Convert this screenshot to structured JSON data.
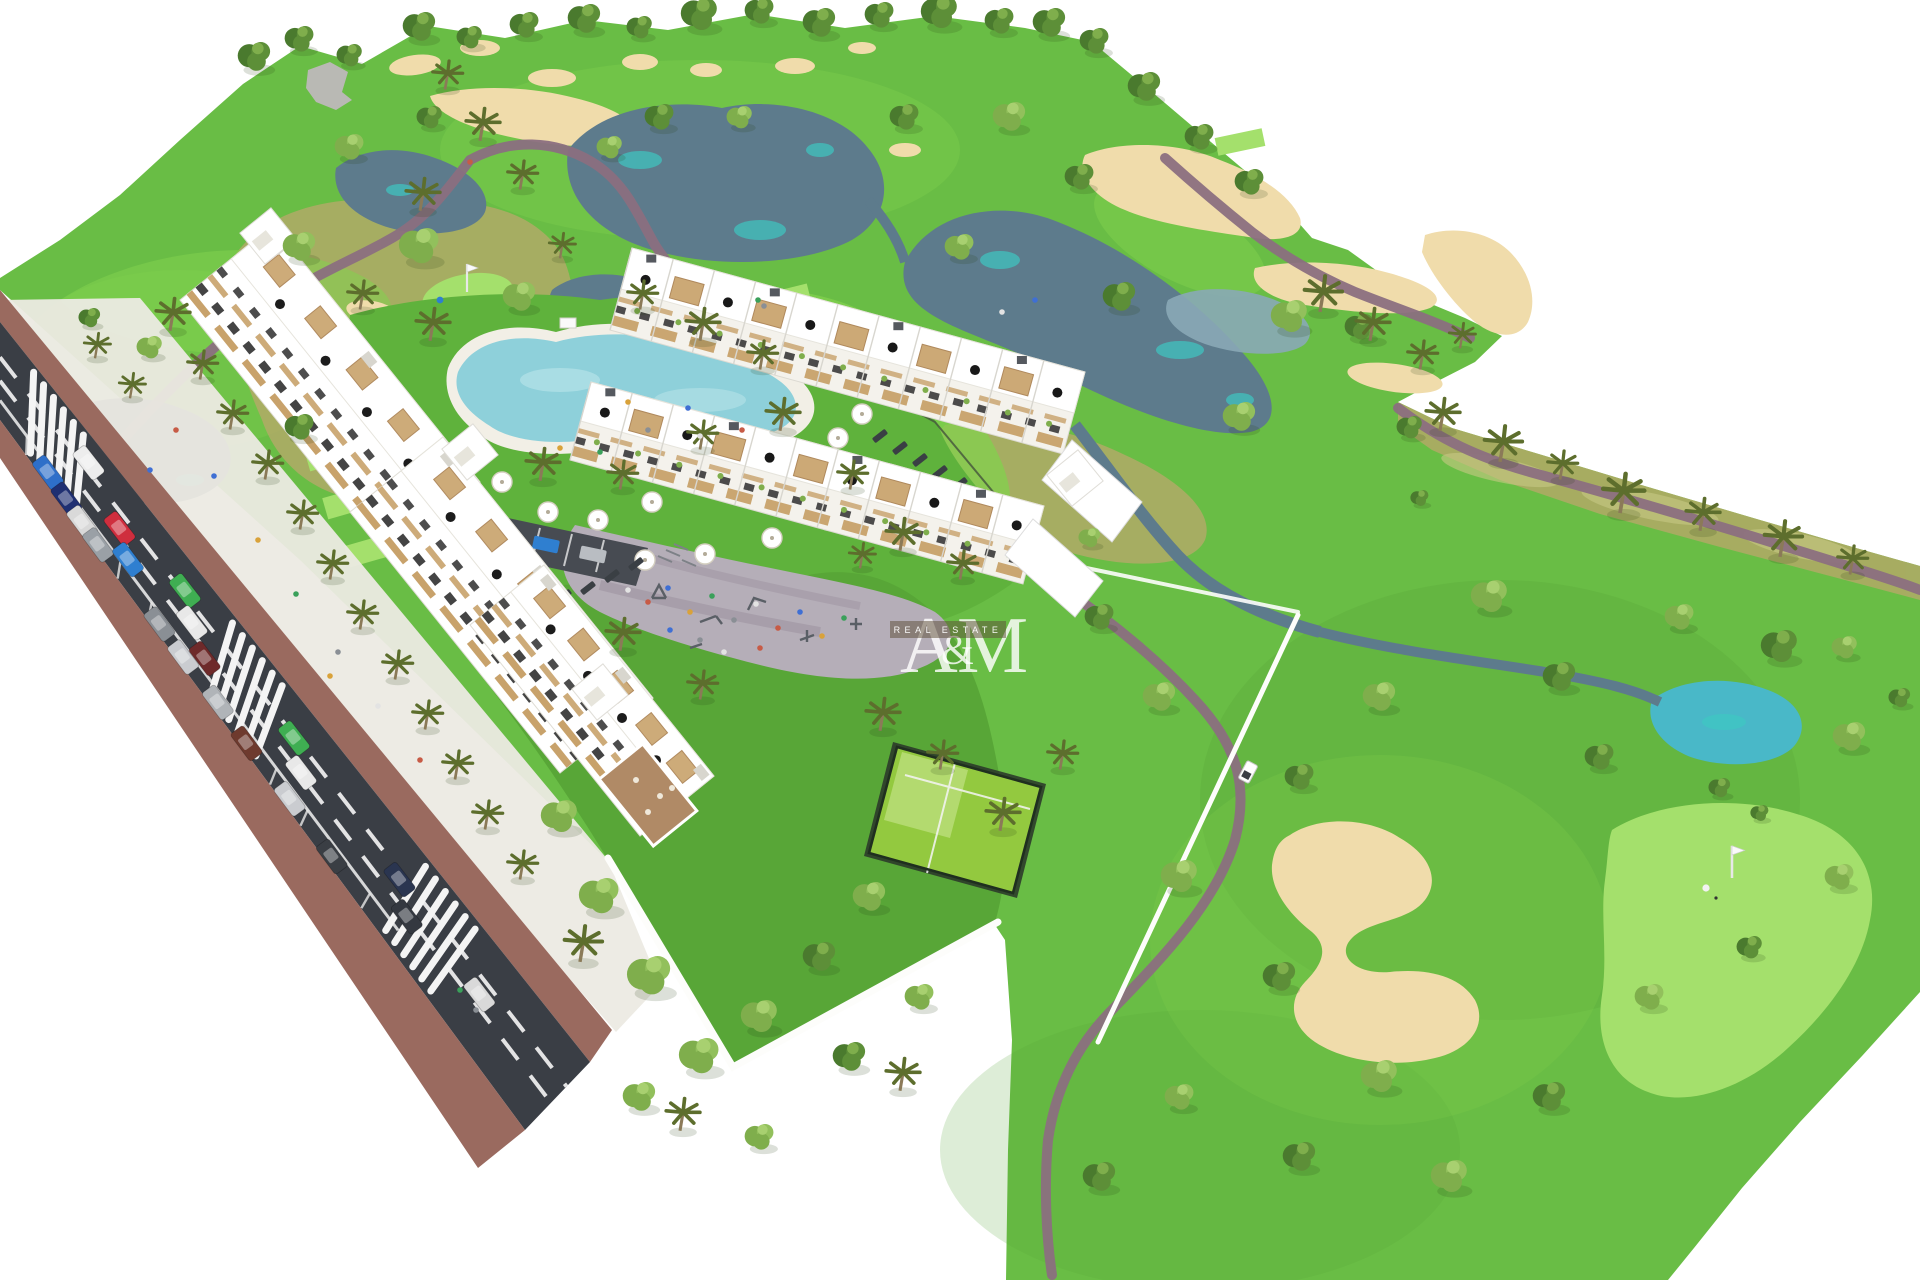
{
  "title": "Aerial 3D architectural rendering of a golf-resort residential development",
  "watermark": {
    "letter_a": "A",
    "ampersand": "&",
    "letter_m": "M",
    "tagline": "REAL ESTATE"
  },
  "palette": {
    "grass": "#69bd45",
    "grassDark": "#56a437",
    "fairway": "#82d14e",
    "greenLight": "#a4e06c",
    "scrub": "#b2aa67",
    "scrubSand": "#d8ca90",
    "sand": "#f0dcab",
    "water": "#5d7b8c",
    "waterLight": "#8aa9b6",
    "waterTeal": "#3ec7c2",
    "pond": "#49b8c8",
    "path": "#8b6f80",
    "road": "#3a3e45",
    "roadLight": "#4a4f57",
    "sidewalk": "#9a6a5f",
    "driveway": "#eceae3",
    "white": "#ffffff",
    "offWhite": "#f4f2ec",
    "facade": "#e7e5dc",
    "wood": "#c8a26b",
    "woodDark": "#a97f4f",
    "windowDark": "#3a3a3a",
    "pool": "#8ed0da",
    "poolLight": "#b5e2e8",
    "court": "#93c93f",
    "courtLight": "#c4e488",
    "wall": "#fdfdfb",
    "plaza": "#b5aeb8",
    "plazaPath": "#a49aa6",
    "parking": "#474b52",
    "fence": "#2c3b2a",
    "treeDark": "#4a7a2e",
    "tree": "#5d8f38",
    "treeLight": "#7fae4c",
    "treeLight2": "#92c05c",
    "palm": "#5d6e2d",
    "trunk": "#8b7a58",
    "rock": "#b9b9b4",
    "shadow": "rgba(40,60,20,0.16)"
  },
  "scene": {
    "setting": "golf course with lakes, sand bunkers, winding cart paths, fairways, tee boxes and palm trees on white background",
    "development": "white modern apartment block with stepped terraces and two long rows of townhouses with roof terraces, pergolas and parasols",
    "amenities": [
      "lagoon swimming pool with sun umbrellas and loungers",
      "children's playground and outdoor gym plaza",
      "padel court with dark fence",
      "private walled gardens",
      "small parking court with bike racks"
    ],
    "surroundings": [
      "diagonal two-lane access road with dashed markings",
      "brick sidewalks",
      "zebra pedestrian crossings",
      "parked and driving cars",
      "white perimeter walls",
      "golf cart on cart path",
      "putting greens with flags and golfers",
      "ponds with turquoise shallows"
    ]
  }
}
